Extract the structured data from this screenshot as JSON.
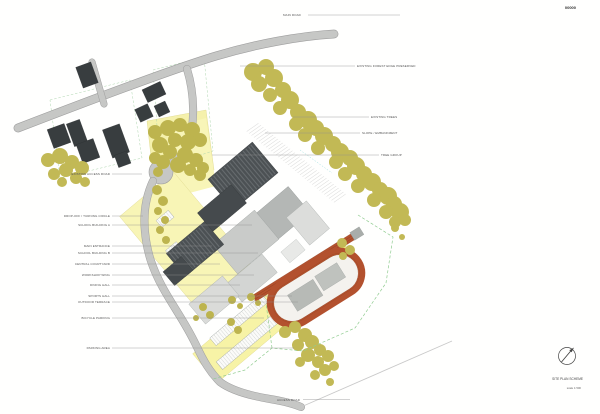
{
  "sheet": {
    "number": "00000",
    "drawing_title": "SITE PLAN SCHEME",
    "drawing_scale": "scale 1:500"
  },
  "road_labels": {
    "top": "MAIN ROAD",
    "bottom": "ACCESS ROAD"
  },
  "annotations": {
    "left": [
      "EXISTING ACCESS ROAD",
      "DROP-OFF / TURNING CIRCLE",
      "SCHOOL BUILDING A",
      "MAIN ENTRANCE",
      "SCHOOL BUILDING B",
      "CENTRAL COURTYARD",
      "WORKSHOP WING",
      "DINING HALL",
      "SPORTS HALL",
      "OUTDOOR TERRACE",
      "BICYCLE PARKING",
      "PARKING AREA"
    ],
    "right": [
      "EXISTING FOREST EDGE PRESERVED",
      "EXISTING TREES",
      "SLOPE / EMBANKMENT",
      "TREE GROUP"
    ]
  },
  "compass": {
    "icon": "north-arrow-icon"
  },
  "colors": {
    "track": "#b3512e",
    "trees": "#c2b955",
    "road": "#c6c7c5",
    "building_dark": "#4c5154",
    "building_light": "#c9cbc9",
    "ground_yellow": "#f7f3a6",
    "boundary_dashed": "#90cc90"
  }
}
